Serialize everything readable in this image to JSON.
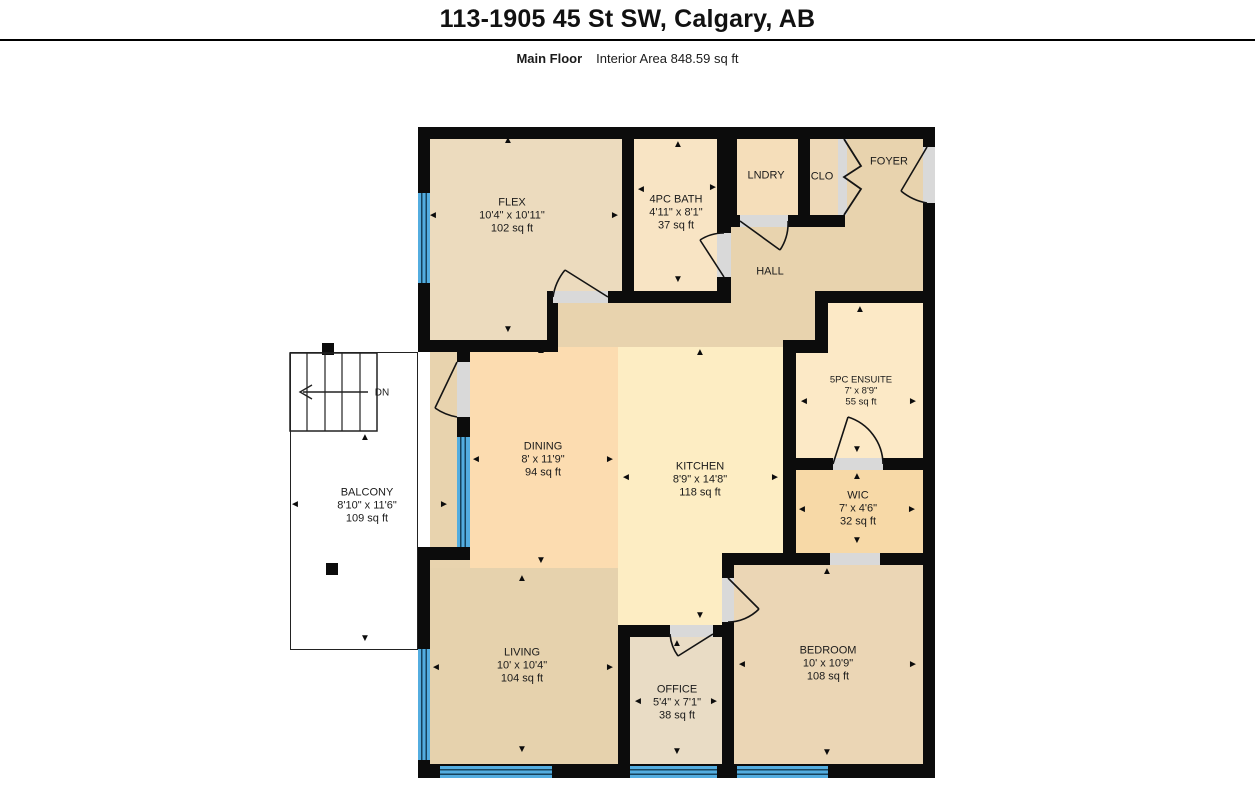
{
  "header": {
    "title": "113-1905 45 St SW, Calgary, AB",
    "floor_label": "Main Floor",
    "interior_area": "Interior Area 848.59 sq ft"
  },
  "rooms": {
    "flex": {
      "name": "FLEX",
      "dims": "10'4\" x 10'11\"",
      "area": "102 sq ft"
    },
    "bath": {
      "name": "4PC BATH",
      "dims": "4'11\" x 8'1\"",
      "area": "37 sq ft"
    },
    "lndry": {
      "name": "LNDRY"
    },
    "clo": {
      "name": "CLO"
    },
    "foyer": {
      "name": "FOYER"
    },
    "hall": {
      "name": "HALL"
    },
    "dining": {
      "name": "DINING",
      "dims": "8' x 11'9\"",
      "area": "94 sq ft"
    },
    "kitchen": {
      "name": "KITCHEN",
      "dims": "8'9\" x 14'8\"",
      "area": "118 sq ft"
    },
    "ensuite": {
      "name": "5PC ENSUITE",
      "dims": "7' x 8'9\"",
      "area": "55 sq ft"
    },
    "wic": {
      "name": "WIC",
      "dims": "7' x 4'6\"",
      "area": "32 sq ft"
    },
    "living": {
      "name": "LIVING",
      "dims": "10' x 10'4\"",
      "area": "104 sq ft"
    },
    "office": {
      "name": "OFFICE",
      "dims": "5'4\" x 7'1\"",
      "area": "38 sq ft"
    },
    "bedroom": {
      "name": "BEDROOM",
      "dims": "10' x 10'9\"",
      "area": "108 sq ft"
    },
    "balcony": {
      "name": "BALCONY",
      "dims": "8'10\" x 11'6\"",
      "area": "109 sq ft"
    }
  },
  "stairs": {
    "direction_label": "DN"
  },
  "colors": {
    "wall": "#0c0c0c",
    "hall_tan": "#e8d3ae",
    "flex": "#ecdbbe",
    "bath": "#f8e4c4",
    "lndry": "#f5deba",
    "clo": "#eed9b8",
    "dining": "#fcdcb0",
    "kitchen": "#fdedc3",
    "living": "#e6d2ad",
    "office": "#e9dcc5",
    "bedroom": "#ebd6b5",
    "ensuite": "#fce9c6",
    "wic": "#f7d9a7",
    "window_blue": "#53ade0",
    "door_sill_gray": "#d9d9d9"
  }
}
